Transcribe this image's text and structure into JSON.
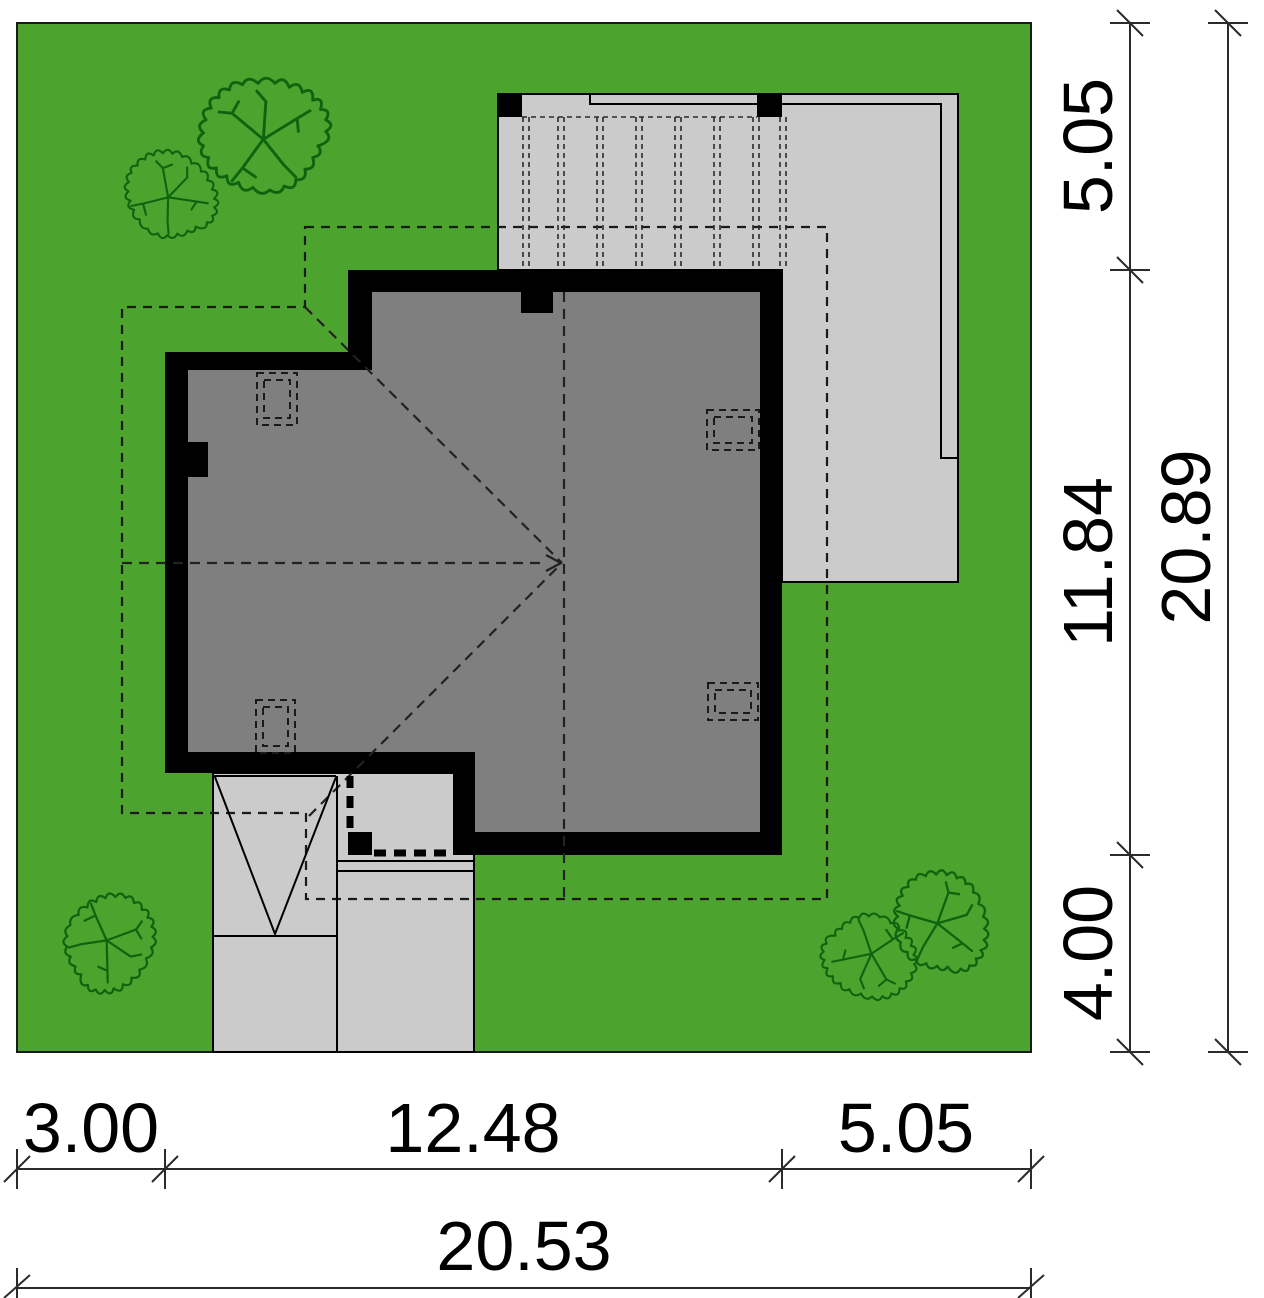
{
  "plan": {
    "dimensions_right": {
      "segments": [
        {
          "label": "5.05"
        },
        {
          "label": "11.84"
        },
        {
          "label": "4.00"
        }
      ],
      "total": {
        "label": "20.89"
      }
    },
    "dimensions_bottom": {
      "segments": [
        {
          "label": "3.00"
        },
        {
          "label": "12.48"
        },
        {
          "label": "5.05"
        }
      ],
      "total": {
        "label": "20.53"
      }
    }
  },
  "colors": {
    "lawn": "#4CA32D",
    "paving": "#CBCBCB",
    "roof": "#7F7F7F",
    "walls": "#000000",
    "tree": "#0E640E",
    "background": "#FFFFFF",
    "dimension_text": "#000000"
  },
  "icons": [
    {
      "name": "tree-icon",
      "meaning": "deciduous tree plan symbol"
    },
    {
      "name": "slope-arrow-icon",
      "meaning": "roof ridge / slope direction arrow"
    }
  ]
}
